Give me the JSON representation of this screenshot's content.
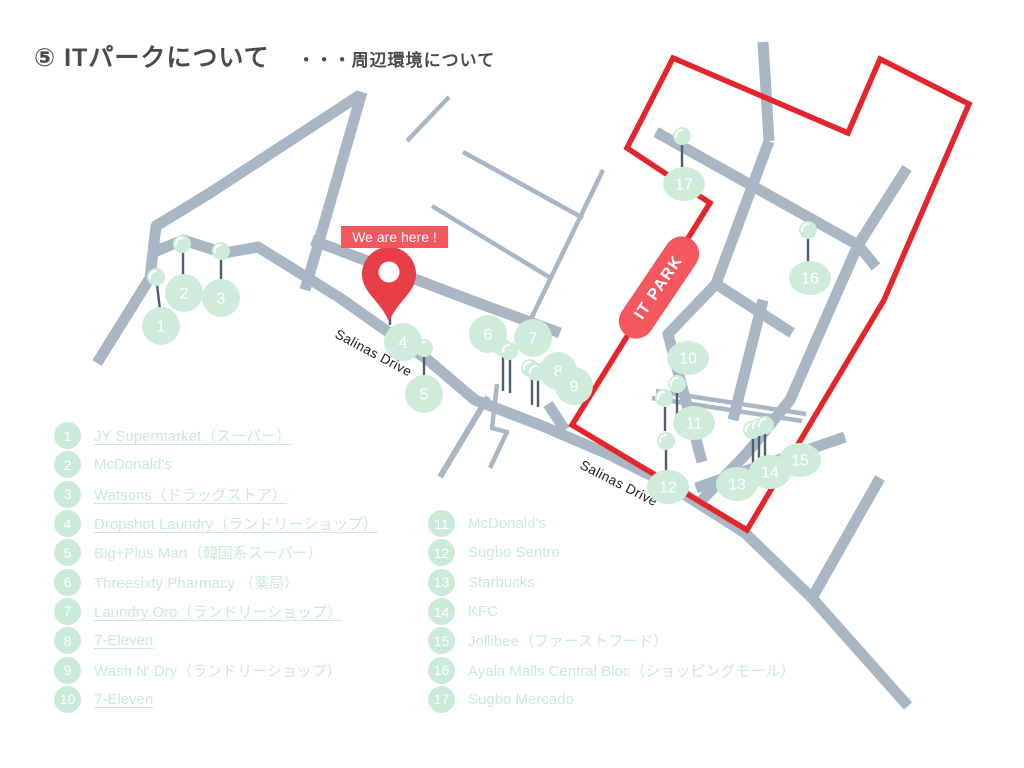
{
  "title": {
    "main": "⑤ ITパークについて",
    "sub": "・・・周辺環境について"
  },
  "map": {
    "we_are_here_label": "We are here !",
    "it_park_label": "IT PARK",
    "road_name_labels": [
      {
        "text": "Salinas Drive",
        "x": 334,
        "y": 337,
        "angle": 28
      },
      {
        "text": "Salinas Drive",
        "x": 579,
        "y": 468,
        "angle": 27
      }
    ],
    "markers": [
      {
        "num": "1",
        "cx": 161,
        "cy": 326,
        "dot": [
          156,
          277
        ],
        "stem": [
          157,
          284,
          160,
          310
        ]
      },
      {
        "num": "2",
        "cx": 184,
        "cy": 293,
        "dot": [
          182,
          244
        ],
        "stem": [
          183,
          251,
          183,
          276
        ]
      },
      {
        "num": "3",
        "cx": 221,
        "cy": 298,
        "dot": [
          221,
          251
        ],
        "stem": [
          221,
          258,
          221,
          281
        ]
      },
      {
        "num": "4",
        "cx": 403,
        "cy": 342,
        "dot": null,
        "stem": [
          390,
          302,
          390,
          325
        ]
      },
      {
        "num": "5",
        "cx": 424,
        "cy": 394,
        "dot": [
          424,
          348
        ],
        "stem": [
          424,
          355,
          424,
          377
        ]
      },
      {
        "num": "6",
        "cx": 488,
        "cy": 334,
        "dot": [
          502,
          347
        ],
        "stem": [
          503,
          354,
          503,
          391
        ]
      },
      {
        "num": "7",
        "cx": 533,
        "cy": 338,
        "dot": [
          509,
          351
        ],
        "stem": [
          510,
          357,
          510,
          393
        ]
      },
      {
        "num": "8",
        "cx": 558,
        "cy": 371,
        "dot": [
          530,
          368
        ],
        "stem": [
          532,
          375,
          532,
          405
        ]
      },
      {
        "num": "9",
        "cx": 574,
        "cy": 386,
        "dot": [
          536,
          372
        ],
        "stem": [
          538,
          379,
          538,
          407
        ]
      },
      {
        "num": "10",
        "cx": 688,
        "cy": 358,
        "dot": [
          677,
          384
        ],
        "stem": [
          677,
          390,
          677,
          423
        ]
      },
      {
        "num": "11",
        "cx": 694,
        "cy": 423,
        "dot": [
          664,
          398
        ],
        "stem": [
          665,
          404,
          665,
          431
        ]
      },
      {
        "num": "12",
        "cx": 668,
        "cy": 487,
        "dot": [
          666,
          441
        ],
        "stem": [
          666,
          447,
          666,
          475
        ]
      },
      {
        "num": "13",
        "cx": 737,
        "cy": 484,
        "dot": [
          752,
          430
        ],
        "stem": [
          753,
          437,
          753,
          464
        ]
      },
      {
        "num": "14",
        "cx": 770,
        "cy": 472,
        "dot": [
          759,
          427
        ],
        "stem": [
          759,
          434,
          759,
          461
        ]
      },
      {
        "num": "15",
        "cx": 800,
        "cy": 460,
        "dot": [
          765,
          425
        ],
        "stem": [
          765,
          432,
          765,
          459
        ]
      },
      {
        "num": "16",
        "cx": 810,
        "cy": 278,
        "dot": [
          808,
          230
        ],
        "stem": [
          808,
          237,
          808,
          262
        ]
      },
      {
        "num": "17",
        "cx": 684,
        "cy": 184,
        "dot": [
          682,
          136
        ],
        "stem": [
          682,
          143,
          682,
          167
        ]
      }
    ]
  },
  "legend": {
    "left": [
      {
        "num": "1",
        "label": "JY Supermarket（スーパー）",
        "link": true
      },
      {
        "num": "2",
        "label": "McDonald's",
        "link": false
      },
      {
        "num": "3",
        "label": "Watsons（ドラッグストア）",
        "link": true
      },
      {
        "num": "4",
        "label": "Dropshot Laundry（ランドリーショップ）",
        "link": true
      },
      {
        "num": "5",
        "label": "Big+Plus Mart（韓国系スーパー）",
        "link": false
      },
      {
        "num": "6",
        "label": "Threesixty Pharmacy （薬局）",
        "link": false
      },
      {
        "num": "7",
        "label": "Laundry Oro（ランドリーショップ）",
        "link": true
      },
      {
        "num": "8",
        "label": "7-Eleven",
        "link": true
      },
      {
        "num": "9",
        "label": "Wash N' Dry（ランドリーショップ）",
        "link": false
      },
      {
        "num": "10",
        "label": "7-Eleven",
        "link": true
      }
    ],
    "right": [
      {
        "num": "11",
        "label": "McDonald's",
        "link": false
      },
      {
        "num": "12",
        "label": "Sugbo Sentro",
        "link": false
      },
      {
        "num": "13",
        "label": "Starbucks",
        "link": false
      },
      {
        "num": "14",
        "label": "KFC",
        "link": false
      },
      {
        "num": "15",
        "label": "Jollibee（ファーストフード）",
        "link": false
      },
      {
        "num": "16",
        "label": "Ayala Malls Central Bloc（ショッピングモール）",
        "link": false
      },
      {
        "num": "17",
        "label": "Sugbo Mercado",
        "link": false
      }
    ]
  },
  "colors": {
    "road": "#a9b7c5",
    "boundary_red": "#e5242c",
    "pin_red": "#e73e48",
    "label_red": "#f4575e",
    "marker_green": "#cfecdb",
    "legend_green": "#c9ebd8",
    "stem_gray": "#4f5f6d",
    "title_gray": "#4b4b4b",
    "road_label_black": "#1f1f1f"
  }
}
